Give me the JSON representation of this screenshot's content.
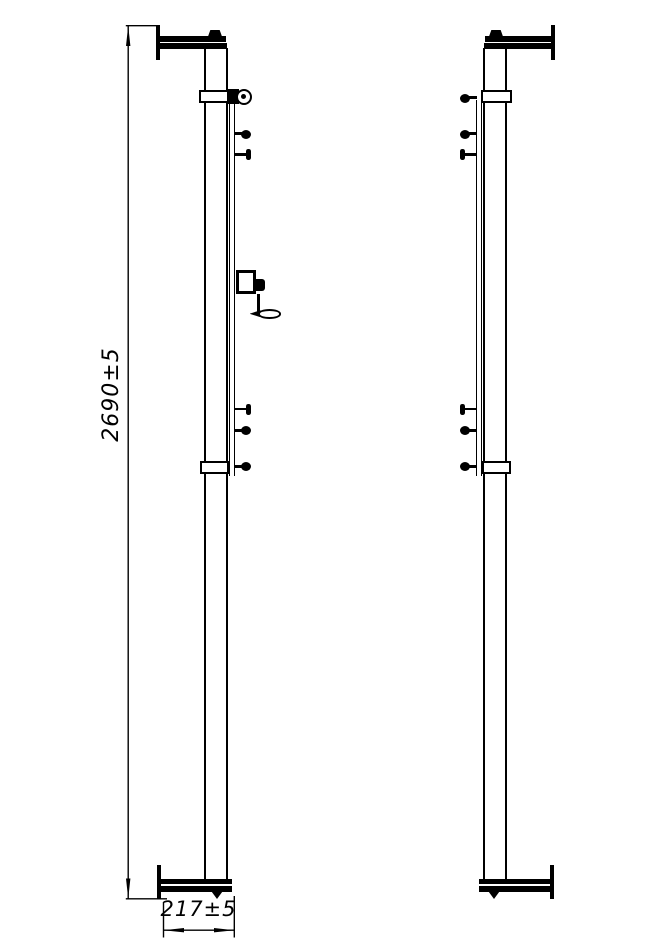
{
  "drawing": {
    "background_color": "#ffffff",
    "line_color": "#000000",
    "dimensions": {
      "overall_height": {
        "text": "2690±5",
        "orientation": "vertical"
      },
      "base_width": {
        "text": "217±5",
        "orientation": "horizontal"
      }
    },
    "parts": {
      "left_post": [
        "top-flange",
        "upper-tube",
        "guide-rail",
        "pulley-eyelet",
        "net-hooks",
        "winch-with-crank-handle",
        "lower-collar",
        "bottom-flange"
      ],
      "right_post": [
        "top-flange",
        "upper-tube",
        "guide-rail",
        "net-hooks",
        "lower-collar",
        "bottom-flange"
      ]
    }
  }
}
